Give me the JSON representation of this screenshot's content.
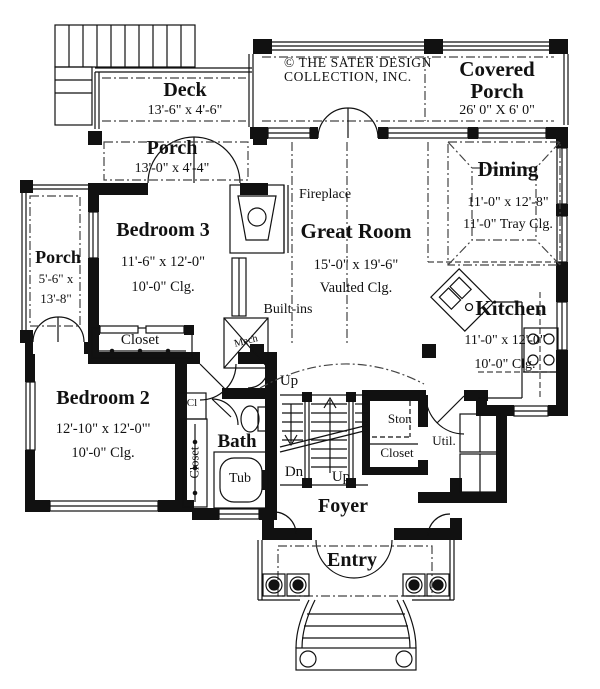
{
  "copyright": "© THE SATER DESIGN COLLECTION, INC.",
  "rooms": {
    "deck": {
      "name": "Deck",
      "dims": "13'-6\" x 4'-6\""
    },
    "covered_porch": {
      "name_line1": "Covered",
      "name_line2": "Porch",
      "dims": "26' 0\" X 6' 0\""
    },
    "porch_top": {
      "name": "Porch",
      "dims": "13'-0\" x 4'-4\""
    },
    "porch_left": {
      "name": "Porch",
      "dims1": "5'-6\" x",
      "dims2": "13'-8\""
    },
    "bedroom3": {
      "name": "Bedroom 3",
      "dims": "11'-6\" x 12'-0\"",
      "clg": "10'-0\"  Clg."
    },
    "great_room": {
      "name": "Great Room",
      "dims": "15'-0\" x 19'-6\"",
      "clg": "Vaulted Clg."
    },
    "dining": {
      "name": "Dining",
      "dims": "11'-0\" x 12'-8\"",
      "clg": "11'-0\" Tray Clg."
    },
    "kitchen": {
      "name": "Kitchen",
      "dims": "11'-0\" x 12'-0\"",
      "clg": "10'-0\"  Clg."
    },
    "bedroom2": {
      "name": "Bedroom 2",
      "dims": "12'-10\" x 12'-0\"'",
      "clg": "10'-0\"  Clg."
    },
    "bath": {
      "name": "Bath"
    },
    "foyer": {
      "name": "Foyer"
    },
    "entry": {
      "name": "Entry"
    },
    "util": {
      "name": "Util."
    },
    "stor": {
      "name": "Stor."
    }
  },
  "labels": {
    "fireplace": "Fireplace",
    "built_ins": "Built-ins",
    "mech": "Mech",
    "tub": "Tub",
    "closet_bedroom3": "Closet",
    "closet_hall": "Closet",
    "closet_stor": "Closet",
    "cl": "Cl",
    "up_top": "Up",
    "up_bottom": "Up",
    "dn": "Dn"
  }
}
